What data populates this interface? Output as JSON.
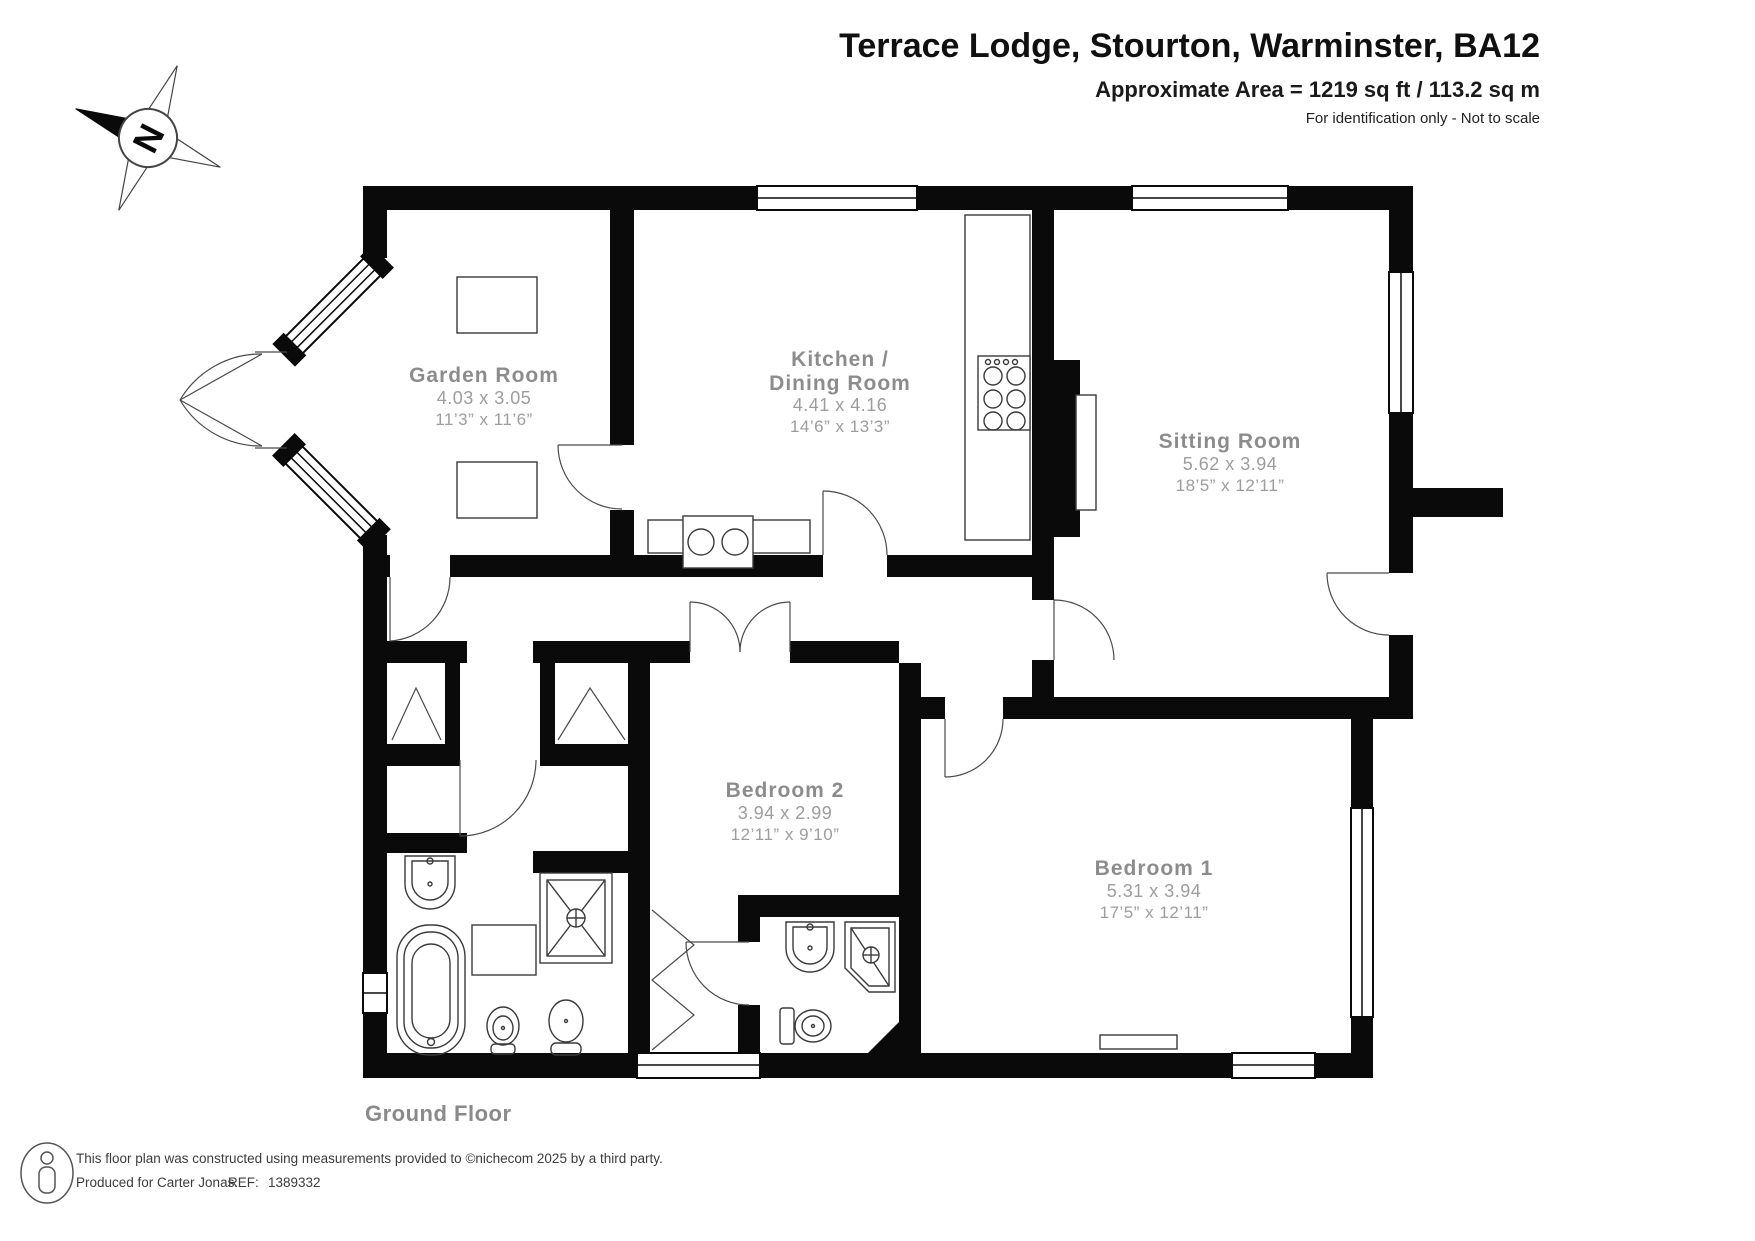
{
  "header": {
    "title": "Terrace Lodge, Stourton, Warminster, BA12",
    "area": "Approximate Area = 1219 sq ft / 113.2 sq m",
    "note": "For identification only - Not to scale"
  },
  "compass": {
    "north": "N"
  },
  "floor": {
    "label": "Ground Floor"
  },
  "rooms": {
    "garden": {
      "name": "Garden Room",
      "metric": "4.03 x 3.05",
      "imperial": "11’3” x 11’6”"
    },
    "kitchen": {
      "name1": "Kitchen /",
      "name2": "Dining Room",
      "metric": "4.41 x 4.16",
      "imperial": "14’6” x 13’3”"
    },
    "sitting": {
      "name": "Sitting Room",
      "metric": "5.62 x 3.94",
      "imperial": "18’5” x 12’11”"
    },
    "bedroom2": {
      "name": "Bedroom 2",
      "metric": "3.94 x 2.99",
      "imperial": "12’11” x 9’10”"
    },
    "bedroom1": {
      "name": "Bedroom 1",
      "metric": "5.31 x 3.94",
      "imperial": "17’5” x 12’11”"
    }
  },
  "footer": {
    "line1": "This floor plan was constructed using measurements provided to ©nichecom 2025 by a third party.",
    "line2": "Produced for Carter Jonas.",
    "ref_label": "REF:",
    "ref_value": "1389332"
  }
}
